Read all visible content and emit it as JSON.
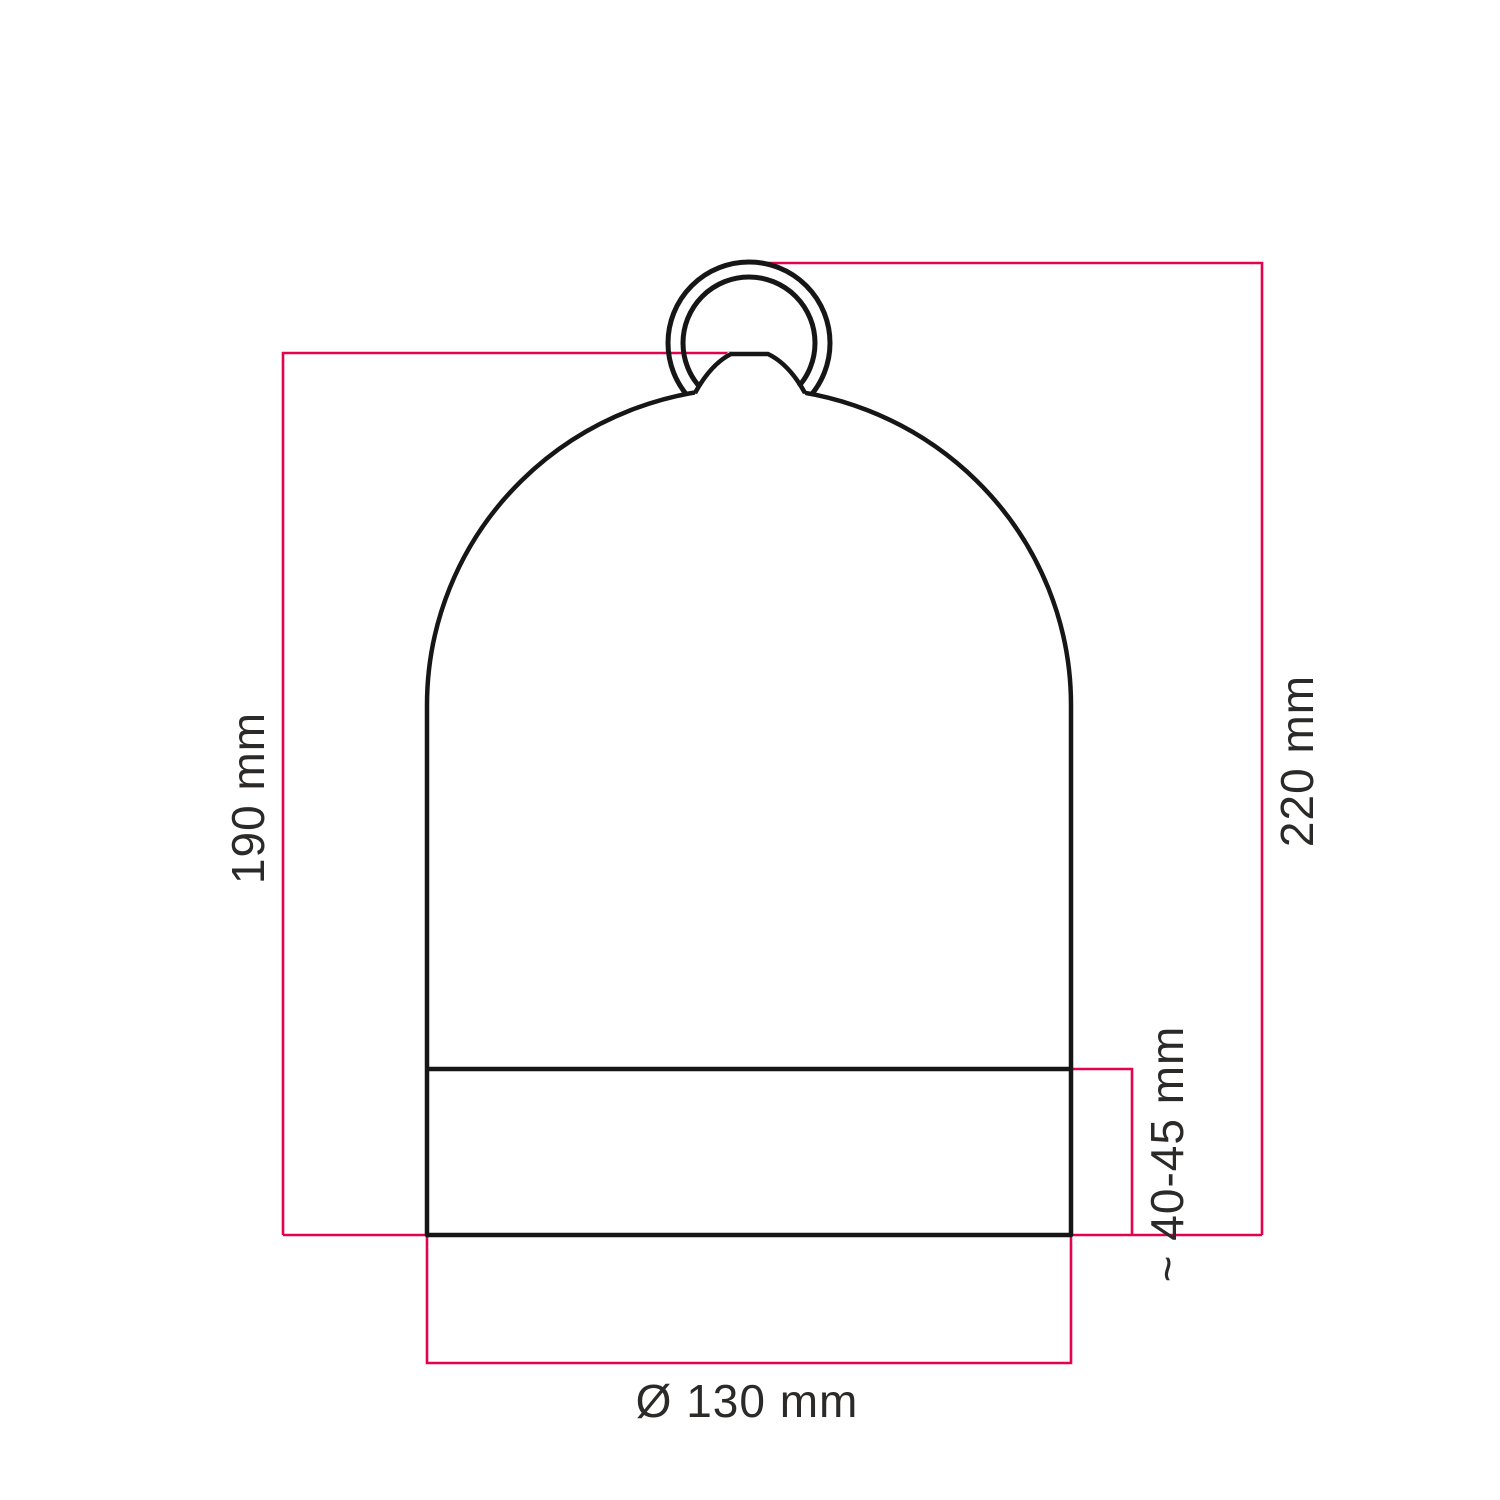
{
  "diagram": {
    "labels": {
      "body_height": "190 mm",
      "total_height": "220 mm",
      "base_height": "~ 40-45 mm",
      "diameter": "Ø 130 mm"
    },
    "colors": {
      "dimension": "#e2024d",
      "outline": "#161616",
      "text": "#2b2a29",
      "background": "#ffffff"
    }
  }
}
